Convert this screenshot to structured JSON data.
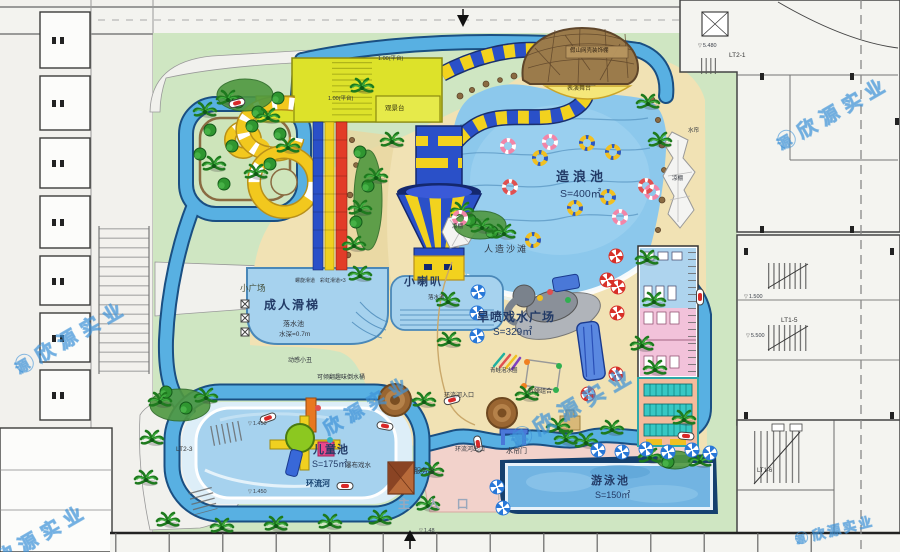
{
  "title_watermark": {
    "text": "欣源实业",
    "logo": "源"
  },
  "icons": {
    "level_triangle": "▽"
  },
  "pools": {
    "wave": {
      "name": "造浪池",
      "area": "S=400㎡"
    },
    "adult": {
      "name": "成人滑梯",
      "landing": "落水池",
      "depth": "水深=0.7m",
      "slide_spiral": "螺旋滑道",
      "slide_rainbow": "彩虹滑道×3"
    },
    "funnel": {
      "name": "小喇叭",
      "landing": "落水池"
    },
    "kids": {
      "name": "儿童池",
      "area": "S=175㎡",
      "waterfall": "瀑布戏水"
    },
    "swim": {
      "name": "游泳池",
      "area": "S=150㎡"
    },
    "river": {
      "name": "环流河",
      "inlet": "环流河入口",
      "outlet": "环流河出口",
      "gate": "水帘门",
      "curtain": "水帘"
    }
  },
  "zones": {
    "beach": "人造沙滩",
    "spray_plaza": "旱喷戏水广场",
    "spray_area": "S=329㎡",
    "small_plaza": "小广场",
    "main_entrance": "主 入 口",
    "service_desk": "服务台",
    "stage": "表演舞台",
    "dome": "假山网壳装饰棚",
    "viewing_deck": "观景台",
    "canopy": "凉棚",
    "platform_level": "1.00(平台)"
  },
  "equipment": {
    "clown": "动感小丑",
    "tipping_bucket": "可倾翻趣味倒水桶",
    "frog_rings": "青蛙泡水圈",
    "bomb_set": "拆弹组合"
  },
  "annotations": {
    "lt2_1": "LT2-1",
    "lt2_3": "LT2-3",
    "lt1_5": "LT1-5",
    "lt1_6": "LT1-6",
    "lv_5480": "5.480",
    "lv_5500": "5.500",
    "lv_1500": "1.500",
    "lv_1450": "1.450",
    "lv_148": "1.48"
  },
  "colors": {
    "grass": "#cfe6c2",
    "sand": "#f1e2b4",
    "water": "#8cc8ec",
    "river": "#58b0e2",
    "pavement_pink": "#f2d2cb",
    "dome_brown": "#9b7b4b",
    "slide_blue": "#2a50c8",
    "slide_yellow": "#f2d21e",
    "slide_red": "#e23c28",
    "platform_yellow": "#dde22a"
  }
}
